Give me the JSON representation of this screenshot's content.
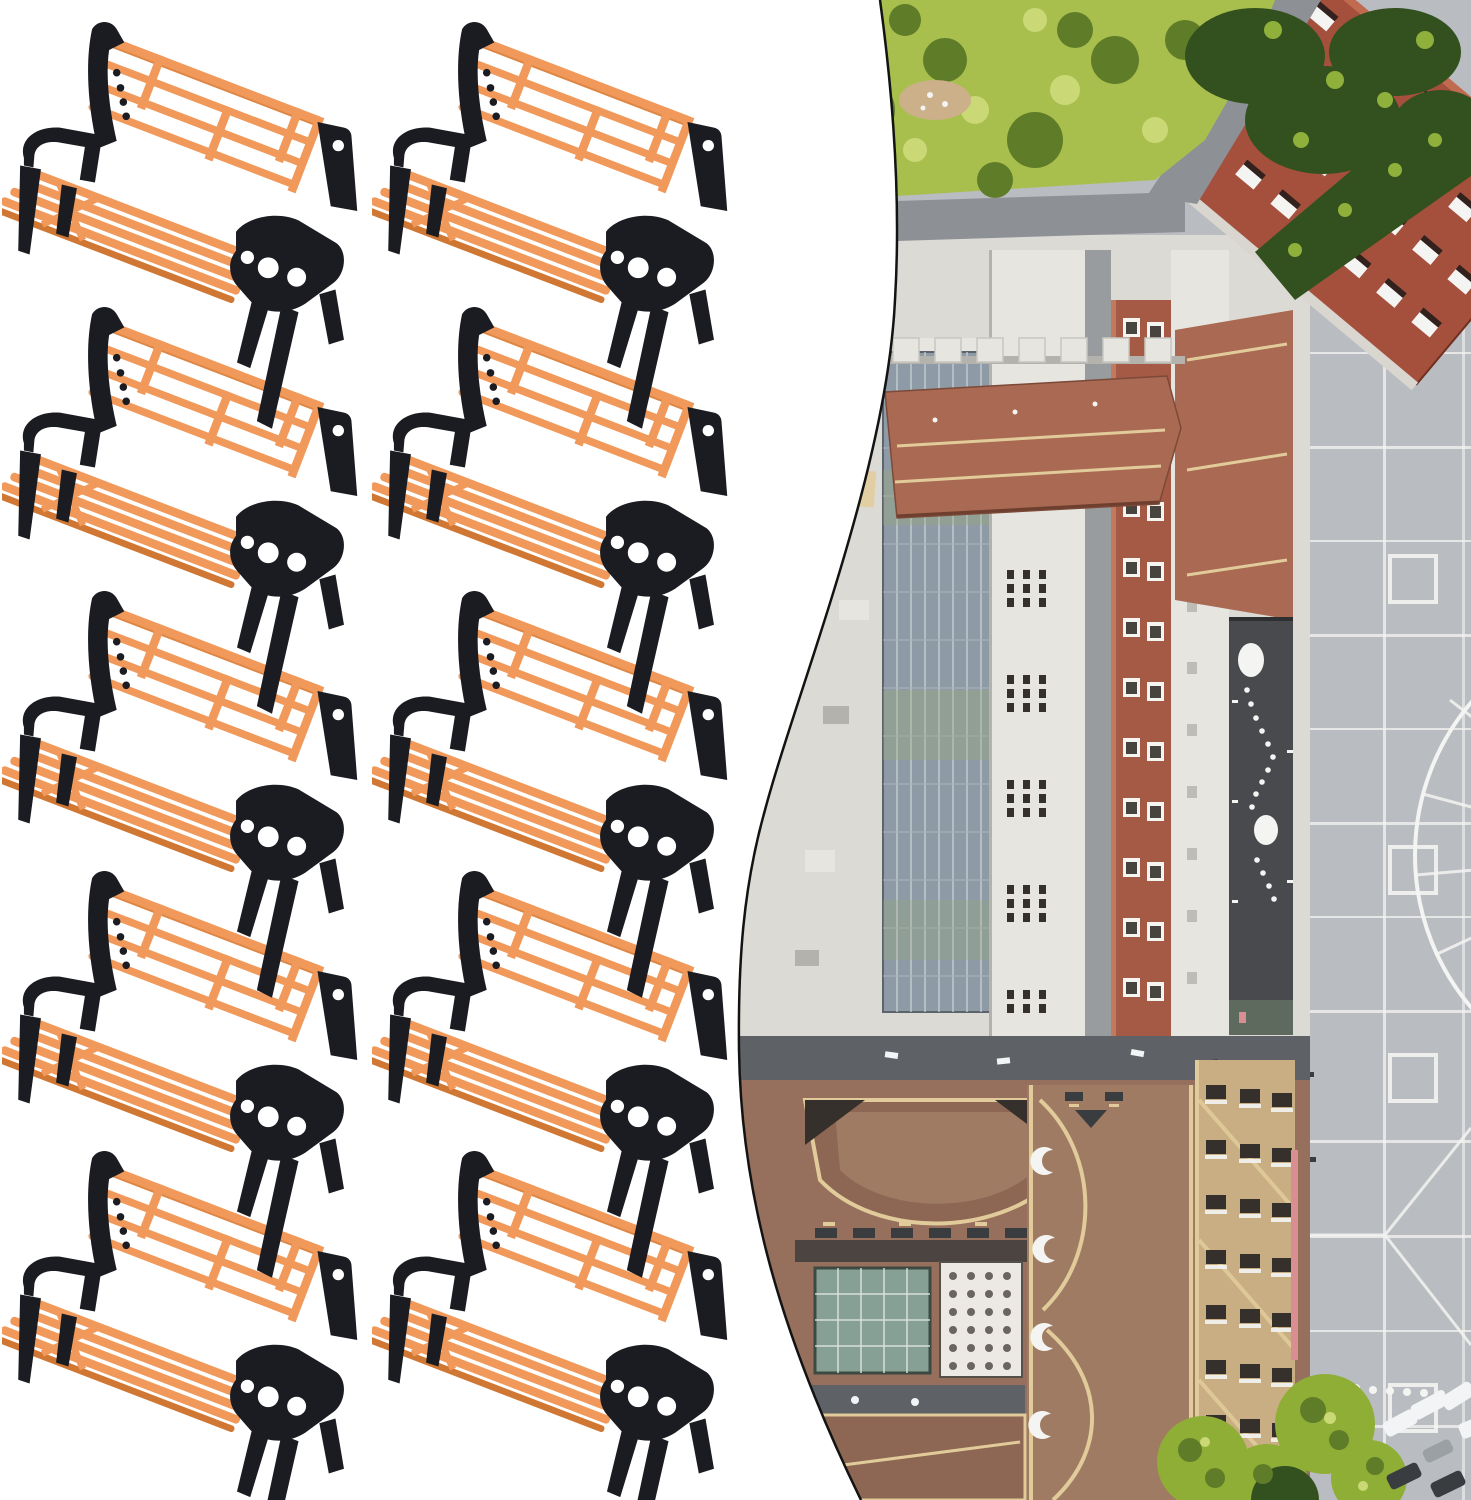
{
  "image": {
    "kind": "product-photo-collage",
    "background": "#ffffff",
    "left_panel": "grid of model park bench figures",
    "right_panel": "aerial view of miniature city layout inside curved inset"
  },
  "colors": {
    "bg": "#ffffff",
    "bench_orange": "#f0995a",
    "bench_orange_light": "#ffbe8a",
    "bench_orange_dark": "#cf7733",
    "bench_black": "#1b1c21",
    "map_border": "#131313",
    "plaza": "#b9bcc0",
    "line_white": "#f4f4f2",
    "park": "#a9bf4d",
    "park_dark": "#5f7c29",
    "park_light": "#cad876",
    "tree_dark": "#33501f",
    "tree_accent": "#8fb03a",
    "road": "#8d9195",
    "white_bldg": "#e7e5e0",
    "white_bldg2": "#dcdad4",
    "glass": "#8e9ba6",
    "glass_line": "#ccd6da",
    "brick": "#a55a46",
    "brick_roof": "#a5503c",
    "red_roof": "#a96952",
    "ridge_tan": "#e2cb9a",
    "dark_roof": "#494a4d",
    "street_dark": "#5e6266",
    "brown1": "#96705c",
    "brown2": "#8d6753",
    "brown3": "#a07b64",
    "greenhouse": "#87a096",
    "canopy": "#ece9e4",
    "beige": "#c8ae82",
    "window_dark": "#35302b",
    "tree_yellow": "#8fae35",
    "car_white": "#f2f4f5",
    "car_dark": "#3a3d40",
    "pink": "#d98f92",
    "shadow_line": "#b4b2ac"
  },
  "benches": {
    "count": 10,
    "rows": 5,
    "columns": 2,
    "item_width": 362,
    "positions": [
      [
        2,
        14
      ],
      [
        372,
        14
      ],
      [
        2,
        299
      ],
      [
        372,
        299
      ],
      [
        2,
        583
      ],
      [
        372,
        583
      ],
      [
        2,
        863
      ],
      [
        372,
        863
      ],
      [
        2,
        1143
      ],
      [
        372,
        1143
      ]
    ]
  },
  "map_inset": {
    "position": "right half, clipped by S-curved left edge with thin black outline",
    "features": [
      "park-trees",
      "roads",
      "red-brick-roof-building",
      "glass-atrium-roof",
      "white-buildings",
      "brick-facade-building",
      "dark-roof-walkway",
      "paved-plaza-grid",
      "circle-plaza-marking",
      "brown-roof-complex",
      "greenhouse-roof",
      "dotted-white-canopy",
      "beige-building",
      "street-trees",
      "parked-cars",
      "pink-edge-strip"
    ]
  }
}
